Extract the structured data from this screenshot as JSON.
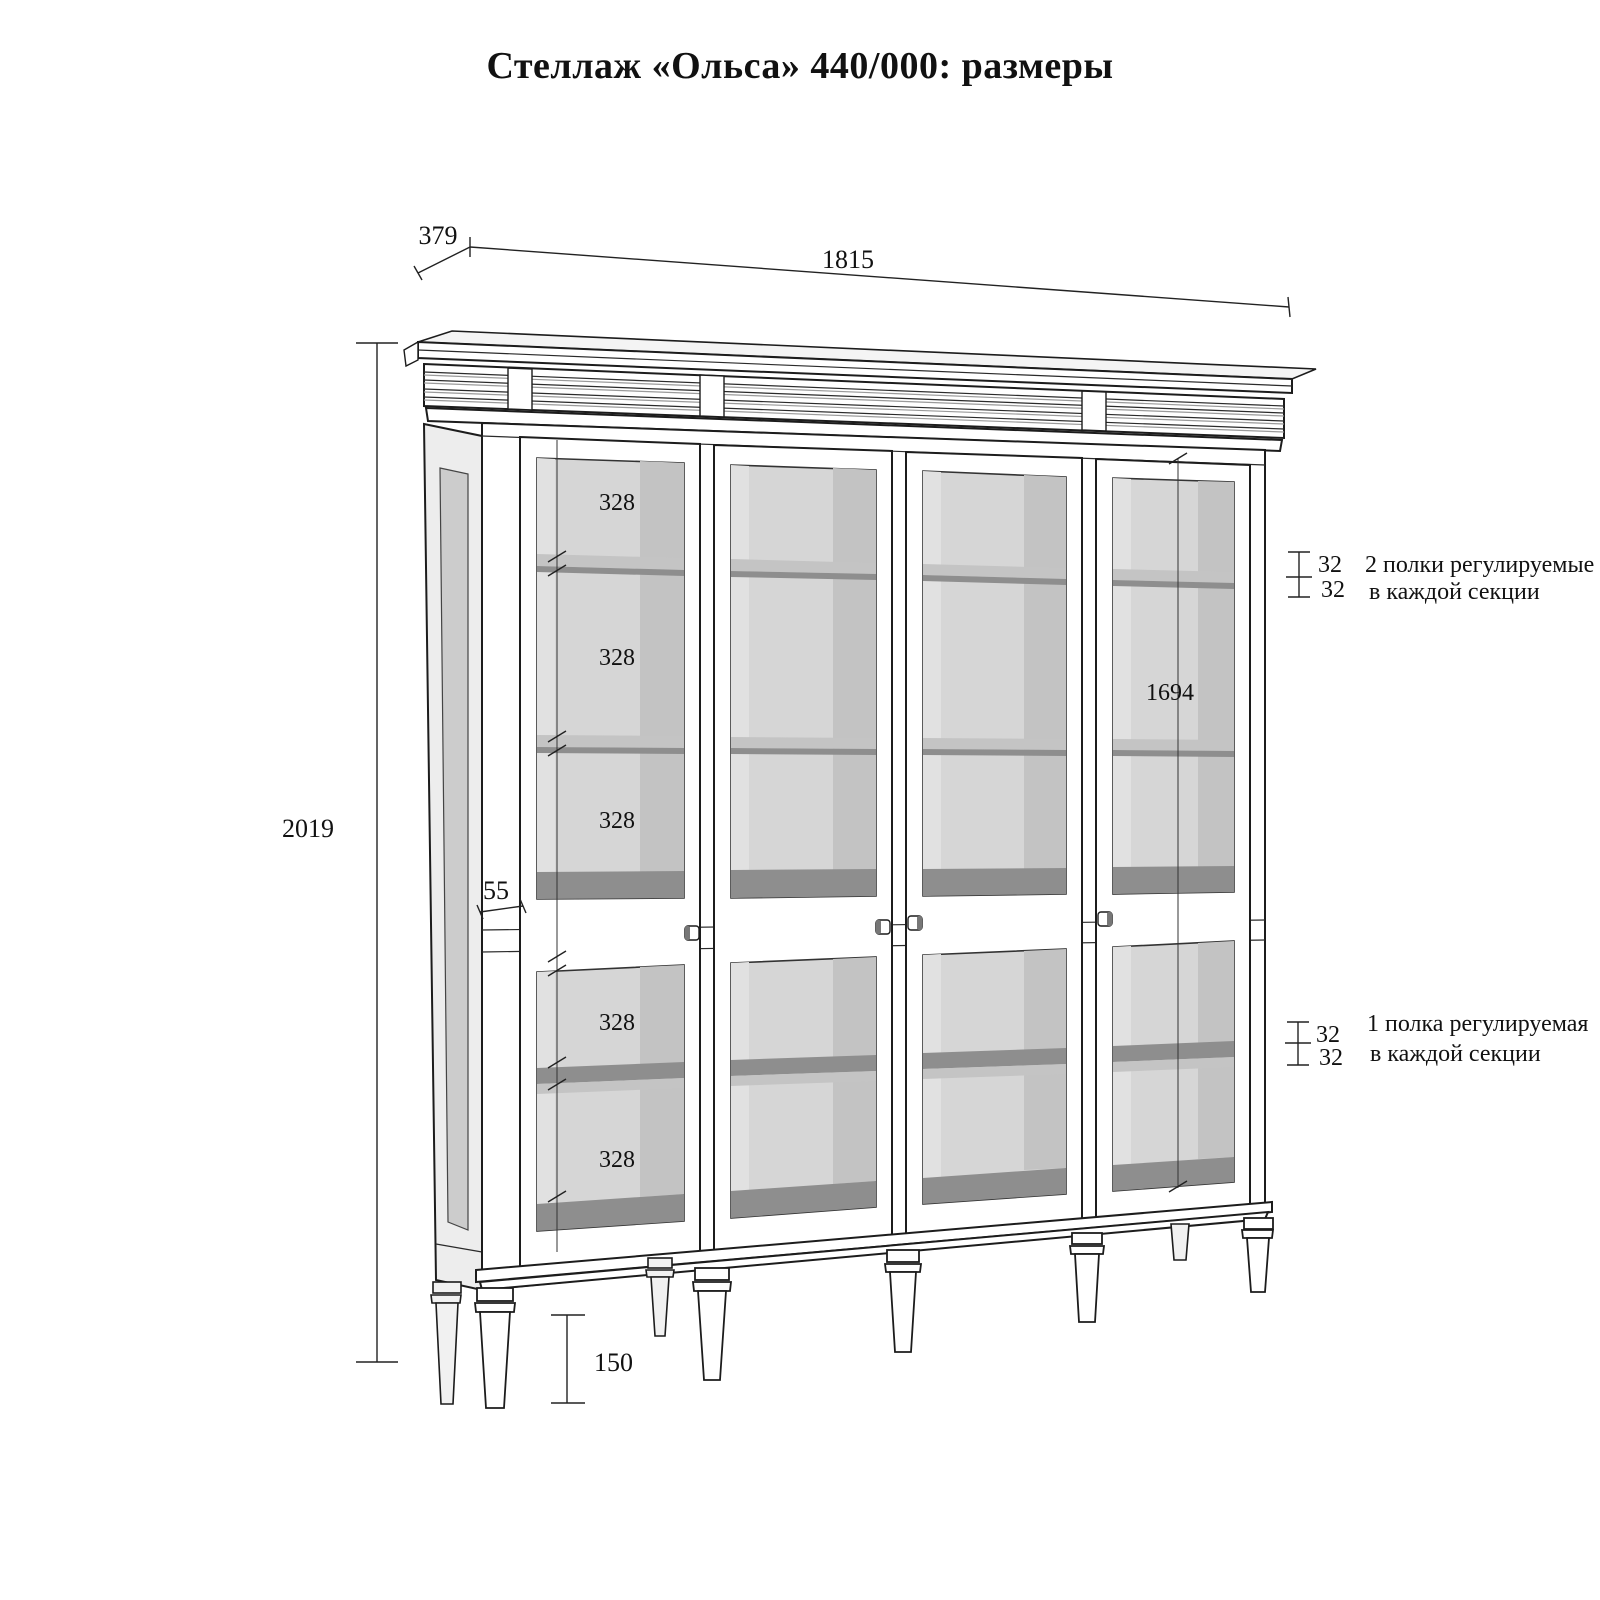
{
  "title": "Стеллаж «Ольса»  440/000: размеры",
  "dims": {
    "depth": "379",
    "width": "1815",
    "height": "2019",
    "interior_height": "1694",
    "leg_height": "150",
    "rail": "55",
    "shelf_gaps": [
      "328",
      "328",
      "328",
      "328",
      "328"
    ],
    "inc_upper": [
      "32",
      "32"
    ],
    "inc_lower": [
      "32",
      "32"
    ]
  },
  "notes": {
    "upper1": "2 полки регулируемые",
    "upper2": "в каждой секции",
    "lower1": "1 полка регулируемая",
    "lower2": "в каждой секции"
  }
}
